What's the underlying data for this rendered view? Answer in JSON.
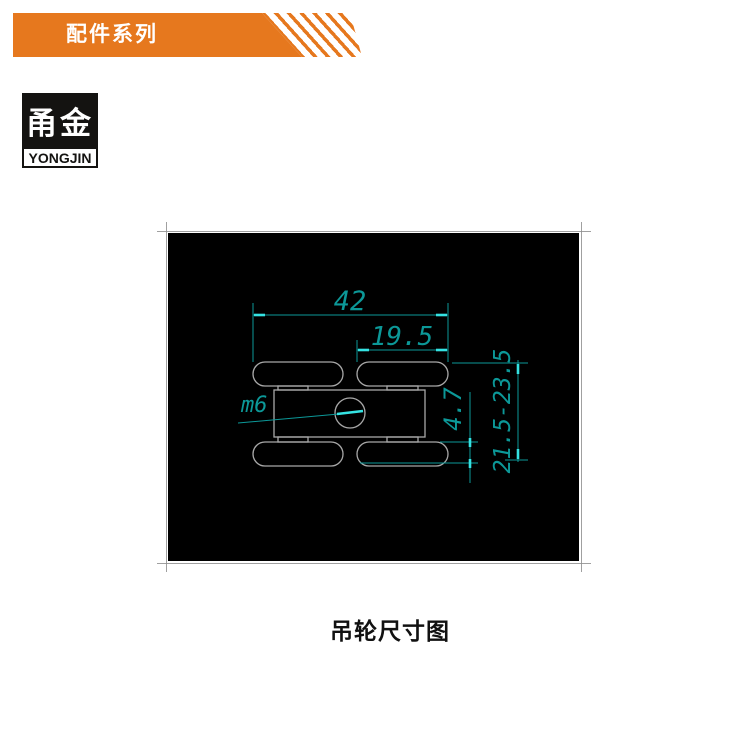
{
  "banner": {
    "title": "配件系列",
    "color": "#e6781e"
  },
  "logo": {
    "hanzi": "甬金",
    "latin": "YONGJIN"
  },
  "diagram": {
    "caption": "吊轮尺寸图",
    "background": "#000000",
    "dim_line_color": "#0c9898",
    "tick_color": "#35e3e3",
    "geometry_color": "#a8a8a8",
    "dimensions": {
      "overall_width": "42",
      "inner_width": "19.5",
      "thread_label": "m6",
      "wheel_thickness": "4.7",
      "height_range": "21.5-23.5"
    }
  }
}
